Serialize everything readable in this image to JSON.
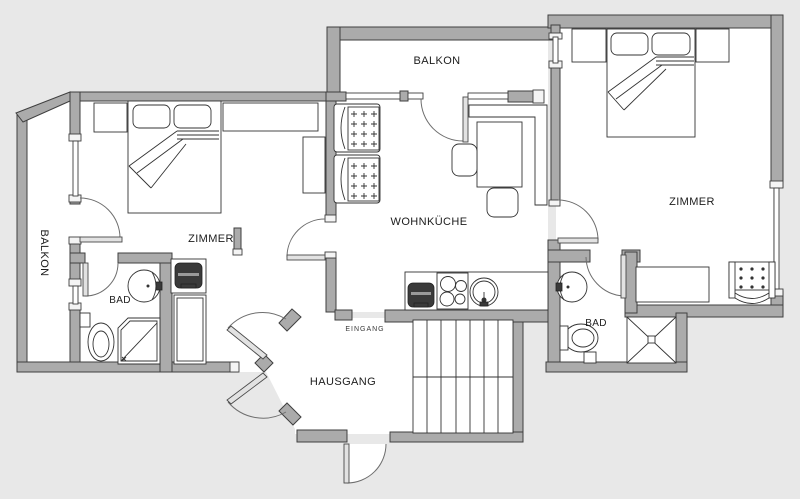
{
  "rooms": {
    "balkon_top": "BALKON",
    "balkon_left": "BALKON",
    "zimmer_left": "ZIMMER",
    "zimmer_right": "ZIMMER",
    "wohnkueche": "WOHNKÜCHE",
    "bad_left": "BAD",
    "bad_right": "BAD",
    "hausgang": "HAUSGANG",
    "eingang": "EINGANG"
  },
  "palette": {
    "background": "#e8e8e8",
    "floor": "#ffffff",
    "wall_fill": "#ababab",
    "wall_outline": "#3f3f3f",
    "furniture_line": "#333333",
    "door_arc": "#6e6e6e",
    "label_text": "#1c1c1c",
    "appliance_dark": "#3a3a3a"
  }
}
